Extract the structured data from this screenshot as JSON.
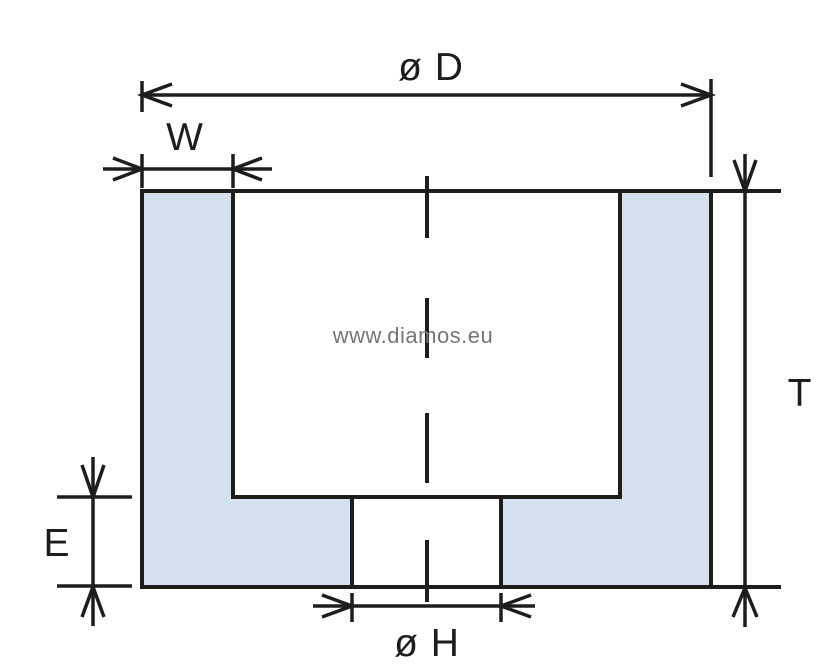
{
  "diagram": {
    "type": "technical-cross-section",
    "subject": "cup grinding wheel cross-section with dimension callouts",
    "watermark": "www.diamos.eu",
    "labels": {
      "outer_diameter": "ø D",
      "rim_width": "W",
      "total_height": "T",
      "base_thickness": "E",
      "bore_diameter": "ø H"
    },
    "colors": {
      "line": "#1d1d1b",
      "fill": "#d3e2ee",
      "watermark": "#757575",
      "background": "#ffffff"
    }
  }
}
